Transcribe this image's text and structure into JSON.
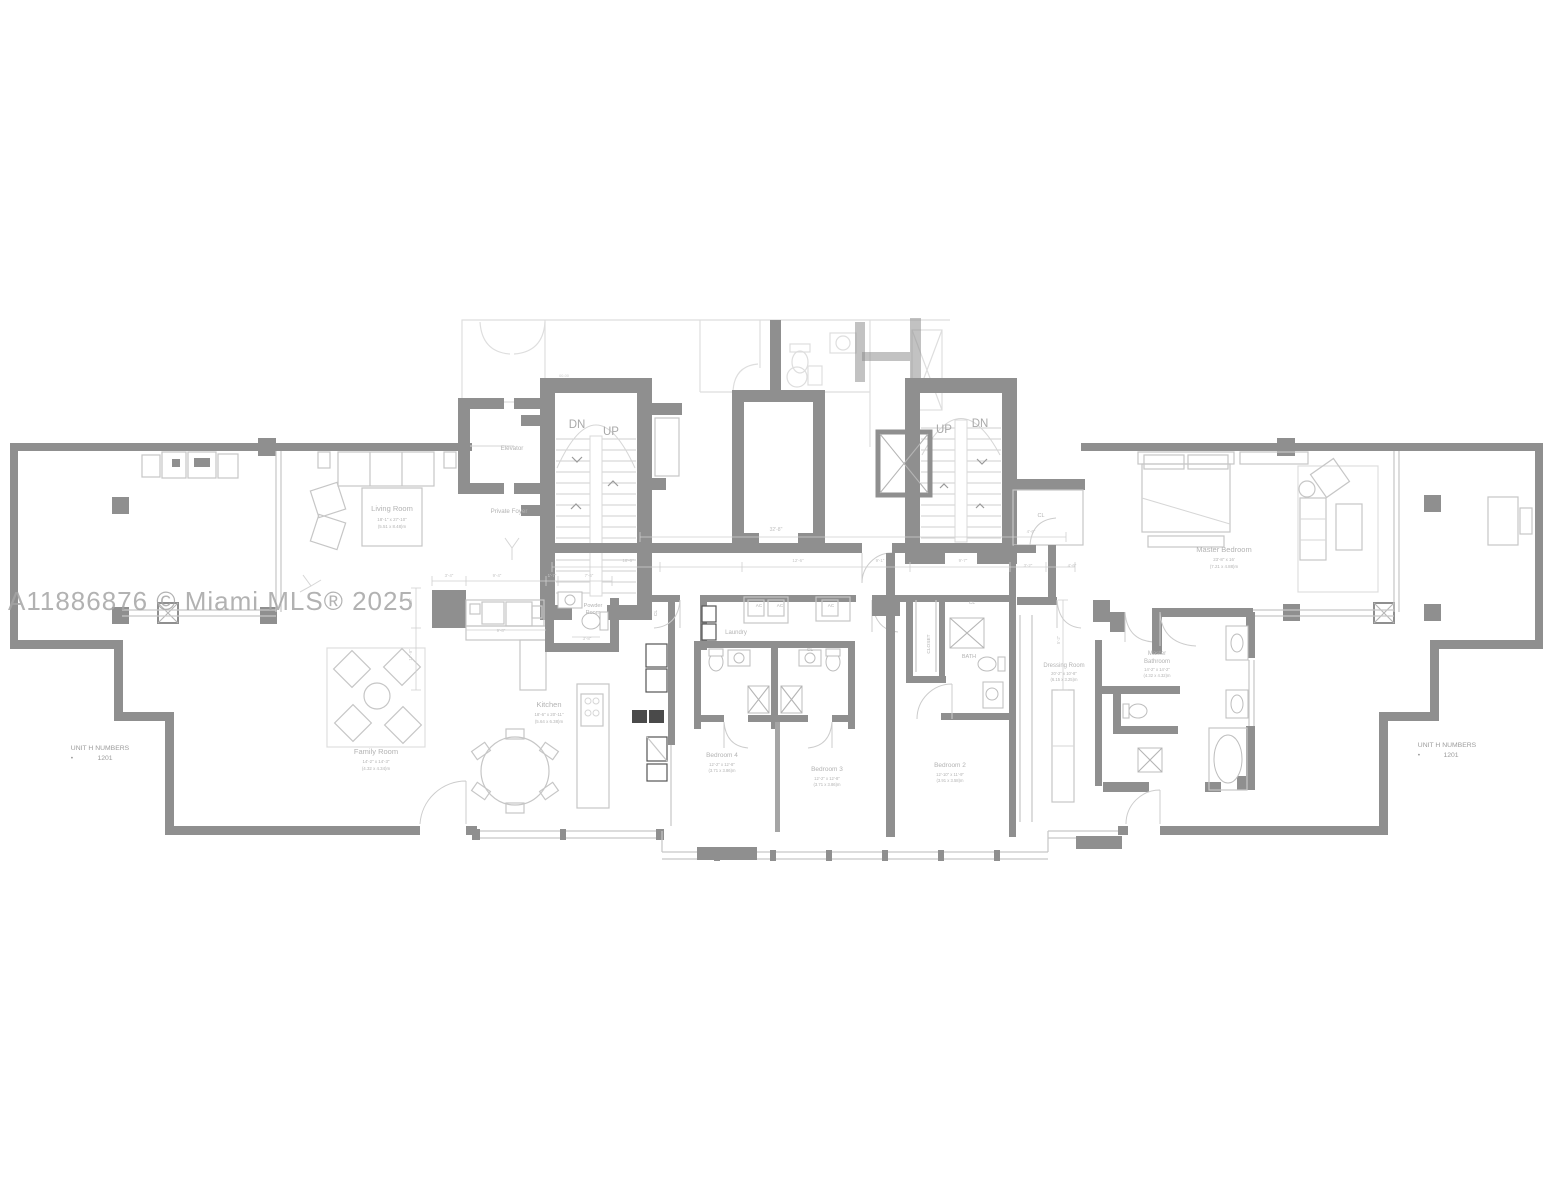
{
  "watermark": "A11886876 © Miami MLS® 2025",
  "colors": {
    "wall": "#8f8f8f",
    "thin_line": "#c6c6c6",
    "label_text": "#b3b3b3",
    "dim_text": "#c6c6c6",
    "watermark_text": "#a5a5a5",
    "background": "#ffffff"
  },
  "unit_numbers": {
    "title": "UNIT H NUMBERS",
    "bullet": "•",
    "number": "1201"
  },
  "stair_labels": {
    "down": "DN",
    "up": "UP"
  },
  "annotations": [
    {
      "id": "living-room-label",
      "text": "Living Room",
      "x": 392,
      "y": 511,
      "size": 7.5
    },
    {
      "id": "living-room-dim-ft",
      "text": "18'-1\" x 27'-10\"",
      "x": 392,
      "y": 521,
      "size": 4.4
    },
    {
      "id": "living-room-dim-m",
      "text": "(5.51 x 8.48)m",
      "x": 392,
      "y": 528,
      "size": 4.4
    },
    {
      "id": "family-room-label",
      "text": "Family Room",
      "x": 376,
      "y": 754,
      "size": 7.5
    },
    {
      "id": "family-room-dim-ft",
      "text": "14'-2\" x 14'-3\"",
      "x": 376,
      "y": 763,
      "size": 4.4
    },
    {
      "id": "family-room-dim-m",
      "text": "(4.32 x 4.34)m",
      "x": 376,
      "y": 770,
      "size": 4.4
    },
    {
      "id": "kitchen-label",
      "text": "Kitchen",
      "x": 549,
      "y": 707,
      "size": 7.5
    },
    {
      "id": "kitchen-dim-ft",
      "text": "18'-6\" x 20'-11\"",
      "x": 549,
      "y": 716,
      "size": 4.4
    },
    {
      "id": "kitchen-dim-m",
      "text": "(5.64 x 6.38)m",
      "x": 549,
      "y": 723,
      "size": 4.4
    },
    {
      "id": "powder-room-line1",
      "text": "Powder",
      "x": 593,
      "y": 607,
      "size": 5.5
    },
    {
      "id": "powder-room-line2",
      "text": "Room",
      "x": 593,
      "y": 614,
      "size": 5.5
    },
    {
      "id": "laundry-label",
      "text": "Laundry",
      "x": 736,
      "y": 634,
      "size": 6
    },
    {
      "id": "bedroom4-label",
      "text": "Bedroom 4",
      "x": 722,
      "y": 757,
      "size": 6.5
    },
    {
      "id": "bedroom4-dim-ft",
      "text": "12'-2\" x 12'-8\"",
      "x": 722,
      "y": 766,
      "size": 4.2
    },
    {
      "id": "bedroom4-dim-m",
      "text": "(3.71 x 3.86)m",
      "x": 722,
      "y": 772,
      "size": 4.2
    },
    {
      "id": "bedroom3-label",
      "text": "Bedroom 3",
      "x": 827,
      "y": 771,
      "size": 6.5
    },
    {
      "id": "bedroom3-dim-ft",
      "text": "12'-2\" x 12'-8\"",
      "x": 827,
      "y": 780,
      "size": 4.2
    },
    {
      "id": "bedroom3-dim-m",
      "text": "(3.71 x 3.86)m",
      "x": 827,
      "y": 786,
      "size": 4.2
    },
    {
      "id": "bedroom2-label",
      "text": "Bedroom 2",
      "x": 950,
      "y": 767,
      "size": 6.5
    },
    {
      "id": "bedroom2-dim-ft",
      "text": "12'-10\" x 11'-9\"",
      "x": 950,
      "y": 776,
      "size": 4.2
    },
    {
      "id": "bedroom2-dim-m",
      "text": "(3.91 x 3.58)m",
      "x": 950,
      "y": 782,
      "size": 4.2
    },
    {
      "id": "master-bedroom-label",
      "text": "Master Bedroom",
      "x": 1224,
      "y": 552,
      "size": 7.5
    },
    {
      "id": "master-bedroom-dim-ft",
      "text": "23'-8\" x 16'",
      "x": 1224,
      "y": 561,
      "size": 4.4
    },
    {
      "id": "master-bedroom-dim-m",
      "text": "(7.21 x 4.88)m",
      "x": 1224,
      "y": 568,
      "size": 4.4
    },
    {
      "id": "dressing-room-label",
      "text": "Dressing Room",
      "x": 1064,
      "y": 667,
      "size": 6
    },
    {
      "id": "dressing-room-dim-ft",
      "text": "20'-2\" x 10'-8\"",
      "x": 1064,
      "y": 675,
      "size": 4.2
    },
    {
      "id": "dressing-room-dim-m",
      "text": "(6.15 x 3.25)m",
      "x": 1064,
      "y": 681,
      "size": 4.2
    },
    {
      "id": "master-bathroom-line1",
      "text": "Master",
      "x": 1157,
      "y": 655,
      "size": 6
    },
    {
      "id": "master-bathroom-line2",
      "text": "Bathroom",
      "x": 1157,
      "y": 663,
      "size": 6
    },
    {
      "id": "master-bathroom-dim-ft",
      "text": "14'-2\" x 14'-2\"",
      "x": 1157,
      "y": 671,
      "size": 4.2
    },
    {
      "id": "master-bathroom-dim-m",
      "text": "(4.32 x 4.32)m",
      "x": 1157,
      "y": 677,
      "size": 4.2
    },
    {
      "id": "bath-label",
      "text": "BATH",
      "x": 969,
      "y": 658,
      "size": 5.5
    },
    {
      "id": "closet-label",
      "text": "CLOSET",
      "x": 930,
      "y": 644,
      "size": 4.8,
      "rot": -90
    },
    {
      "id": "cl-hall-label",
      "text": "CL",
      "x": 1041,
      "y": 517,
      "size": 5.5
    },
    {
      "id": "cl-bath-block-label",
      "text": "CL",
      "x": 810,
      "y": 651,
      "size": 4.8
    },
    {
      "id": "cl-bedroom2-label",
      "text": "CL",
      "x": 972,
      "y": 604,
      "size": 4.8
    },
    {
      "id": "cl-kitchen-label",
      "text": "CL",
      "x": 657,
      "y": 613,
      "size": 4.8,
      "rot": -90
    },
    {
      "id": "ac-1-label",
      "text": "AC",
      "x": 759,
      "y": 607,
      "size": 4.6
    },
    {
      "id": "ac-2-label",
      "text": "AC",
      "x": 780,
      "y": 607,
      "size": 4.6
    },
    {
      "id": "ac-3-label",
      "text": "AC",
      "x": 831,
      "y": 607,
      "size": 4.6
    },
    {
      "id": "elevator-label",
      "text": "Elevator",
      "x": 512,
      "y": 450,
      "size": 6.2
    },
    {
      "id": "private-foyer-label",
      "text": "Private Foyer",
      "x": 509,
      "y": 513,
      "size": 6.2
    },
    {
      "id": "stair-left-dn",
      "text": "DN",
      "x": 577,
      "y": 428,
      "size": 11.5,
      "color": "#a9a9a9"
    },
    {
      "id": "stair-left-up",
      "text": "UP",
      "x": 611,
      "y": 435,
      "size": 11.5,
      "color": "#a9a9a9"
    },
    {
      "id": "stair-right-up",
      "text": "UP",
      "x": 944,
      "y": 433,
      "size": 11.5,
      "color": "#a9a9a9"
    },
    {
      "id": "stair-right-dn",
      "text": "DN",
      "x": 980,
      "y": 427,
      "size": 11.5,
      "color": "#a9a9a9"
    },
    {
      "id": "unit-left-title",
      "text": "UNIT H NUMBERS",
      "x": 100,
      "y": 750,
      "size": 6.8,
      "color": "#9c9c9c"
    },
    {
      "id": "unit-left-bullet",
      "text": "•",
      "x": 72,
      "y": 760,
      "size": 6.8,
      "color": "#9c9c9c"
    },
    {
      "id": "unit-left-number",
      "text": "1201",
      "x": 105,
      "y": 760,
      "size": 6.8,
      "color": "#9c9c9c"
    },
    {
      "id": "unit-right-title",
      "text": "UNIT H NUMBERS",
      "x": 1447,
      "y": 747,
      "size": 6.8,
      "color": "#9c9c9c"
    },
    {
      "id": "unit-right-bullet",
      "text": "•",
      "x": 1419,
      "y": 757,
      "size": 6.8,
      "color": "#9c9c9c"
    },
    {
      "id": "unit-right-number",
      "text": "1201",
      "x": 1451,
      "y": 757,
      "size": 6.8,
      "color": "#9c9c9c"
    },
    {
      "id": "door-tag",
      "text": "00-00",
      "x": 564,
      "y": 377,
      "size": 3.8,
      "color": "#cccccc"
    },
    {
      "id": "dim-32-8",
      "text": "32'-8\"",
      "x": 776,
      "y": 531,
      "size": 5,
      "color": "#c0c0c0"
    },
    {
      "id": "dim-18-6",
      "text": "18'-6\"",
      "x": 628,
      "y": 562,
      "size": 4.4,
      "color": "#c6c6c6"
    },
    {
      "id": "dim-12-6",
      "text": "12'-6\"",
      "x": 798,
      "y": 562,
      "size": 4.4,
      "color": "#c6c6c6"
    },
    {
      "id": "dim-9-1",
      "text": "9'-1\"",
      "x": 880,
      "y": 562,
      "size": 4.4,
      "color": "#c6c6c6"
    },
    {
      "id": "dim-9-7",
      "text": "9'-7\"",
      "x": 963,
      "y": 562,
      "size": 4.4,
      "color": "#c6c6c6"
    },
    {
      "id": "dim-3-2",
      "text": "3'-2\"",
      "x": 1028,
      "y": 567,
      "size": 4.4,
      "color": "#c6c6c6"
    },
    {
      "id": "dim-4-6a",
      "text": "4'-6\"",
      "x": 1072,
      "y": 567,
      "size": 4.4,
      "color": "#c6c6c6"
    },
    {
      "id": "dim-4-6b",
      "text": "4'-6\"",
      "x": 1031,
      "y": 533,
      "size": 4.4,
      "color": "#c6c6c6"
    },
    {
      "id": "dim-3-4",
      "text": "3'-4\"",
      "x": 449,
      "y": 577,
      "size": 4.4,
      "color": "#c6c6c6"
    },
    {
      "id": "dim-9-4",
      "text": "9'-4\"",
      "x": 497,
      "y": 577,
      "size": 4.4,
      "color": "#c6c6c6"
    },
    {
      "id": "dim-1-7",
      "text": "1'-7\"",
      "x": 552,
      "y": 577,
      "size": 4.4,
      "color": "#c6c6c6"
    },
    {
      "id": "dim-7-6",
      "text": "7'-6\"",
      "x": 589,
      "y": 577,
      "size": 4.4,
      "color": "#c6c6c6"
    },
    {
      "id": "dim-9-8",
      "text": "9'-8\"",
      "x": 501,
      "y": 632,
      "size": 4.4,
      "color": "#c6c6c6"
    },
    {
      "id": "dim-3-8",
      "text": "3'-8\"",
      "x": 587,
      "y": 640,
      "size": 4.4,
      "color": "#c6c6c6"
    },
    {
      "id": "dim-17-9",
      "text": "17'-9\"",
      "x": 412,
      "y": 655,
      "size": 4.4,
      "rot": -90,
      "color": "#c6c6c6"
    },
    {
      "id": "dim-8-8",
      "text": "8'-8\"",
      "x": 412,
      "y": 602,
      "size": 4.2,
      "rot": -90,
      "color": "#c6c6c6"
    },
    {
      "id": "dim-5-2",
      "text": "5'-2\"",
      "x": 1060,
      "y": 640,
      "size": 4.2,
      "rot": -90,
      "color": "#c6c6c6"
    }
  ]
}
